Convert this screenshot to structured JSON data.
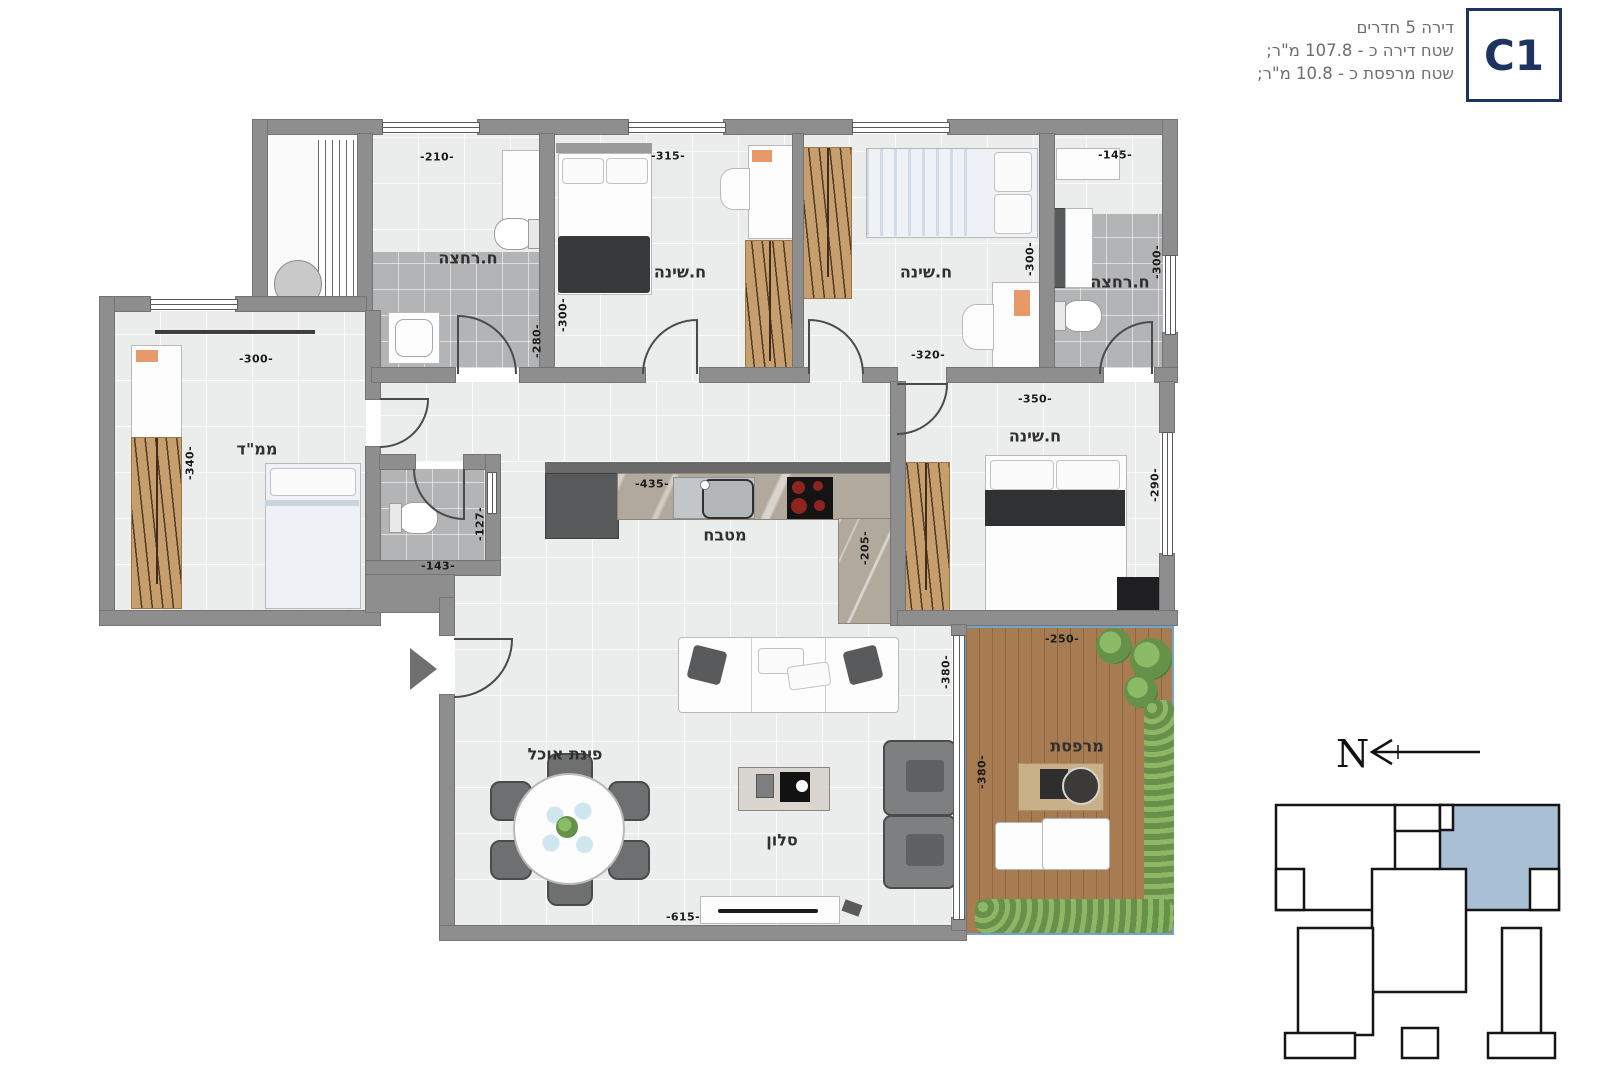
{
  "header": {
    "line1": "דירה 5 חדרים",
    "line2": "שטח דירה כ - 107.8 מ\"ר;",
    "line3": "שטח מרפסת כ - 10.8 מ\"ר;",
    "unit_code": "C1"
  },
  "rooms": {
    "bathroom1": "ח.רחצה",
    "bedroom1": "ח.שינה",
    "bedroom2": "ח.שינה",
    "bathroom2": "ח.רחצה",
    "safe_room": "ממ\"ד",
    "kitchen": "מטבח",
    "master_bedroom": "ח.שינה",
    "dining": "פינת אוכל",
    "living": "סלון",
    "balcony": "מרפסת"
  },
  "dimensions": {
    "bathroom1_w": "-210-",
    "bedroom1_w": "-315-",
    "bathroom2_w": "-145-",
    "bedroom1_h": "-300-",
    "bathroom1_h": "-280-",
    "bedroom2_h": "-300-",
    "bathroom2_h": "-300-",
    "bedroom2_w": "-320-",
    "master_w": "-350-",
    "safe_room_w": "-300-",
    "safe_room_h": "-340-",
    "wc_h": "-127-",
    "wc_w": "-143-",
    "kitchen_w": "-435-",
    "kitchen_h": "-205-",
    "master_h": "-290-",
    "balcony_w": "-250-",
    "living_h": "-380-",
    "balcony_h": "-380-",
    "living_w": "-615-"
  },
  "compass": {
    "north": "N"
  },
  "colors": {
    "accent_navy": "#1e3360",
    "keyplan_highlight": "#a9bfd6",
    "wall": "#8e8e8e",
    "deck": "#a87c52"
  }
}
